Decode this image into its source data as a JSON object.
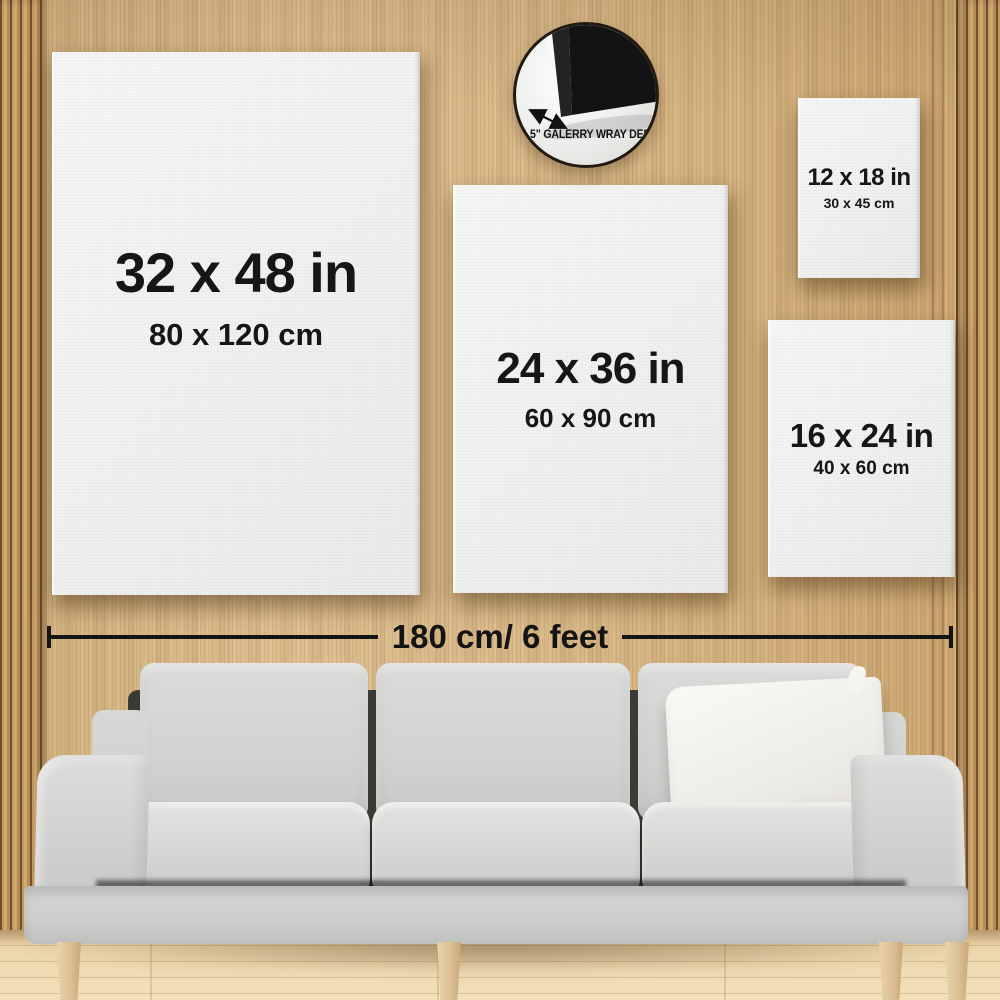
{
  "badge": {
    "label": "1.5\" GALERRY WRAY DEPT",
    "icon": "canvas-corner-icon",
    "arrow_icon": "double-arrow-icon"
  },
  "canvases": [
    {
      "id": "32x48",
      "inches": "32 x 48 in",
      "cm": "80 x 120 cm"
    },
    {
      "id": "24x36",
      "inches": "24 x 36 in",
      "cm": "60 x 90 cm"
    },
    {
      "id": "12x18",
      "inches": "12 x 18 in",
      "cm": "30 x 45 cm"
    },
    {
      "id": "16x24",
      "inches": "16 x 24 in",
      "cm": "40 x 60 cm"
    }
  ],
  "measurement": {
    "label": "180 cm/ 6 feet"
  },
  "colors": {
    "wall_wood": "#d5b385",
    "floor_wood": "#ecd7ad",
    "canvas_white": "#f3f3f1",
    "text": "#161616",
    "sofa_gray": "#d4d5d3",
    "pillow_white": "#f5f4f0",
    "badge_canvas_black": "#131313"
  }
}
